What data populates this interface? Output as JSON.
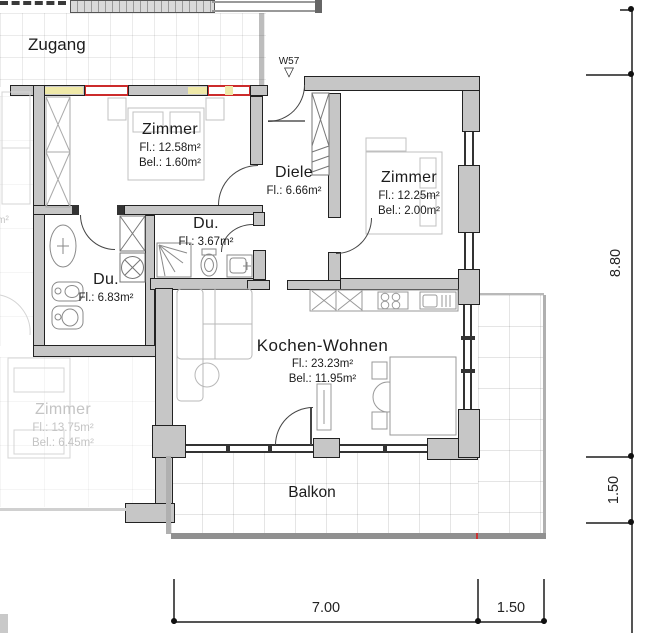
{
  "plan": {
    "zugang": {
      "label": "Zugang"
    },
    "entry": {
      "code": "W57",
      "marker": "▽"
    },
    "rooms": {
      "zimmer_nw": {
        "name": "Zimmer",
        "fl": "Fl.: 12.58m²",
        "bel": "Bel.: 1.60m²"
      },
      "diele": {
        "name": "Diele",
        "fl": "Fl.: 6.66m²"
      },
      "zimmer_ne": {
        "name": "Zimmer",
        "fl": "Fl.: 12.25m²",
        "bel": "Bel.: 2.00m²"
      },
      "du_klein": {
        "name": "Du.",
        "fl": "Fl.: 3.67m²"
      },
      "du_gross": {
        "name": "Du.",
        "fl": "Fl.: 6.83m²"
      },
      "kochen_wohnen": {
        "name": "Kochen-Wohnen",
        "fl": "Fl.: 23.23m²",
        "bel": "Bel.: 11.95m²"
      },
      "balkon": {
        "name": "Balkon"
      },
      "neighbor_zimmer": {
        "name": "Zimmer",
        "fl": "Fl.: 13.75m²",
        "bel": "Bel.: 6.45m²"
      },
      "neighbor_fragment": "m²"
    },
    "dimensions": {
      "right_upper": "8.80",
      "right_lower": "1.50",
      "bottom_main": "7.00",
      "bottom_balkon": "1.50"
    },
    "colors": {
      "wall_fill": "#c6c6c6",
      "wall_edge": "#222222",
      "window_red": "#cc2b2b",
      "sill_yellow": "#efe9a8",
      "faded_text": "#c4c4c4"
    }
  }
}
